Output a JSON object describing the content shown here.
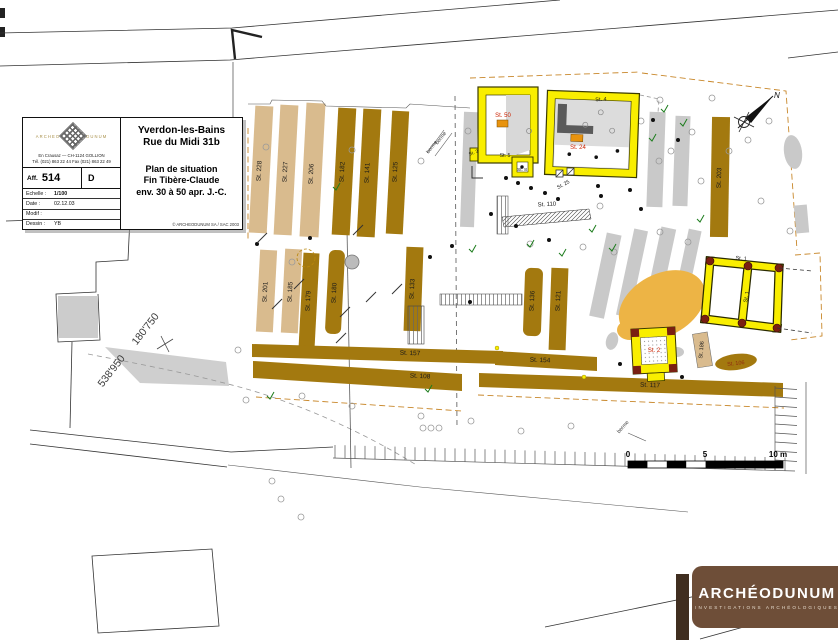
{
  "title_block": {
    "logo_left": "ARCHEO",
    "logo_right": "DUNUM",
    "address_line1": "En Crausaz — CH-1124 GOLLION",
    "address_line2": "Tél. (021) 863 22 44  Fax (021) 863 22 49",
    "aff_label": "Aff.",
    "aff_value": "514",
    "rev_value": "D",
    "info_rows": [
      {
        "label": "Echelle :",
        "value": "1/100",
        "bold": true
      },
      {
        "label": "Date :",
        "value": "02.12.03",
        "bold": false
      },
      {
        "label": "Modif :",
        "value": "",
        "bold": false
      },
      {
        "label": "Dessin :",
        "value": "YB",
        "bold": false
      }
    ],
    "site_line1": "Yverdon-les-Bains",
    "site_line2": "Rue du Midi 31b",
    "plan_line1": "Plan de situation",
    "plan_line2": "Fin Tibère-Claude",
    "plan_line3": "env. 30 à 50 apr. J.-C.",
    "copyright": "© ARCHEODUNUM SA / SAC 2003"
  },
  "map": {
    "north_label": "N",
    "scale_labels": {
      "zero": "0",
      "five": "5",
      "ten": "10 m"
    },
    "coord_east": "180'750",
    "coord_north": "538'950",
    "berme_label": "berme"
  },
  "structures": [
    {
      "label": "St. 228",
      "x": 261,
      "y": 171,
      "rot": -87
    },
    {
      "label": "St. 227",
      "x": 287,
      "y": 172,
      "rot": -87
    },
    {
      "label": "St. 206",
      "x": 313,
      "y": 174,
      "rot": -87
    },
    {
      "label": "St. 182",
      "x": 344,
      "y": 172,
      "rot": -87
    },
    {
      "label": "St. 141",
      "x": 369,
      "y": 173,
      "rot": -87
    },
    {
      "label": "St. 125",
      "x": 397,
      "y": 172,
      "rot": -87
    },
    {
      "label": "St. 201",
      "x": 267,
      "y": 292,
      "rot": -87
    },
    {
      "label": "St. 185",
      "x": 292,
      "y": 292,
      "rot": -87
    },
    {
      "label": "St. 179",
      "x": 310,
      "y": 301,
      "rot": -87
    },
    {
      "label": "St. 180",
      "x": 336,
      "y": 293,
      "rot": -87
    },
    {
      "label": "St. 133",
      "x": 414,
      "y": 289,
      "rot": -87
    },
    {
      "label": "St. 136",
      "x": 534,
      "y": 301,
      "rot": -87
    },
    {
      "label": "St. 121",
      "x": 560,
      "y": 301,
      "rot": -87
    },
    {
      "label": "St. 203",
      "x": 721,
      "y": 178,
      "rot": -88
    },
    {
      "label": "St. 157",
      "x": 410,
      "y": 355,
      "rot": 2
    },
    {
      "label": "St. 154",
      "x": 540,
      "y": 362,
      "rot": 2
    },
    {
      "label": "St. 117",
      "x": 650,
      "y": 387,
      "rot": 2
    },
    {
      "label": "St. 108",
      "x": 420,
      "y": 378,
      "rot": 3
    },
    {
      "label": "St. 110",
      "x": 547,
      "y": 206,
      "rot": -3,
      "fs": 6
    },
    {
      "label": "St. 106",
      "x": 736,
      "y": 365,
      "rot": -6,
      "fs": 5.5,
      "fill": "#8f2a10"
    },
    {
      "label": "St. 186",
      "x": 703,
      "y": 350,
      "rot": -85,
      "fs": 5.5
    },
    {
      "label": "St. 50",
      "x": 503,
      "y": 117,
      "fill": "#cc2200",
      "fs": 6
    },
    {
      "label": "St. 24",
      "x": 578,
      "y": 149,
      "fill": "#cc2200",
      "fs": 6
    },
    {
      "label": "St. 25",
      "x": 564,
      "y": 186,
      "rot": -28,
      "fs": 5.2
    },
    {
      "label": "St. 5",
      "x": 505,
      "y": 157,
      "fs": 5.2
    },
    {
      "label": "St. 8",
      "x": 522,
      "y": 171,
      "fs": 4.8
    },
    {
      "label": "St. 3",
      "x": 474,
      "y": 154,
      "rot": -20,
      "fs": 4.8
    },
    {
      "label": "St. 4",
      "x": 601,
      "y": 101,
      "rot": -3,
      "fs": 5.5
    },
    {
      "label": "St. 2",
      "x": 654,
      "y": 352,
      "fill": "#cc2200",
      "fs": 6
    },
    {
      "label": "St. 1",
      "x": 741,
      "y": 260,
      "rot": 5,
      "fs": 5.5
    },
    {
      "label": "St. 1",
      "x": 748,
      "y": 297,
      "rot": -80,
      "fs": 5.5
    }
  ],
  "footer_logo": {
    "name": "ARCHÉODUNUM",
    "tagline": "INVESTIGATIONS ARCHÉOLOGIQUES"
  },
  "colors": {
    "stripe_tan": "#d9bb8e",
    "stripe_brown": "#a3790f",
    "building_yellow": "#f9ee00",
    "deposit_orange": "#edb445",
    "label_red": "#cc2200",
    "trench_dash": "#c8872a",
    "logo_brown": "#6e4e38"
  }
}
